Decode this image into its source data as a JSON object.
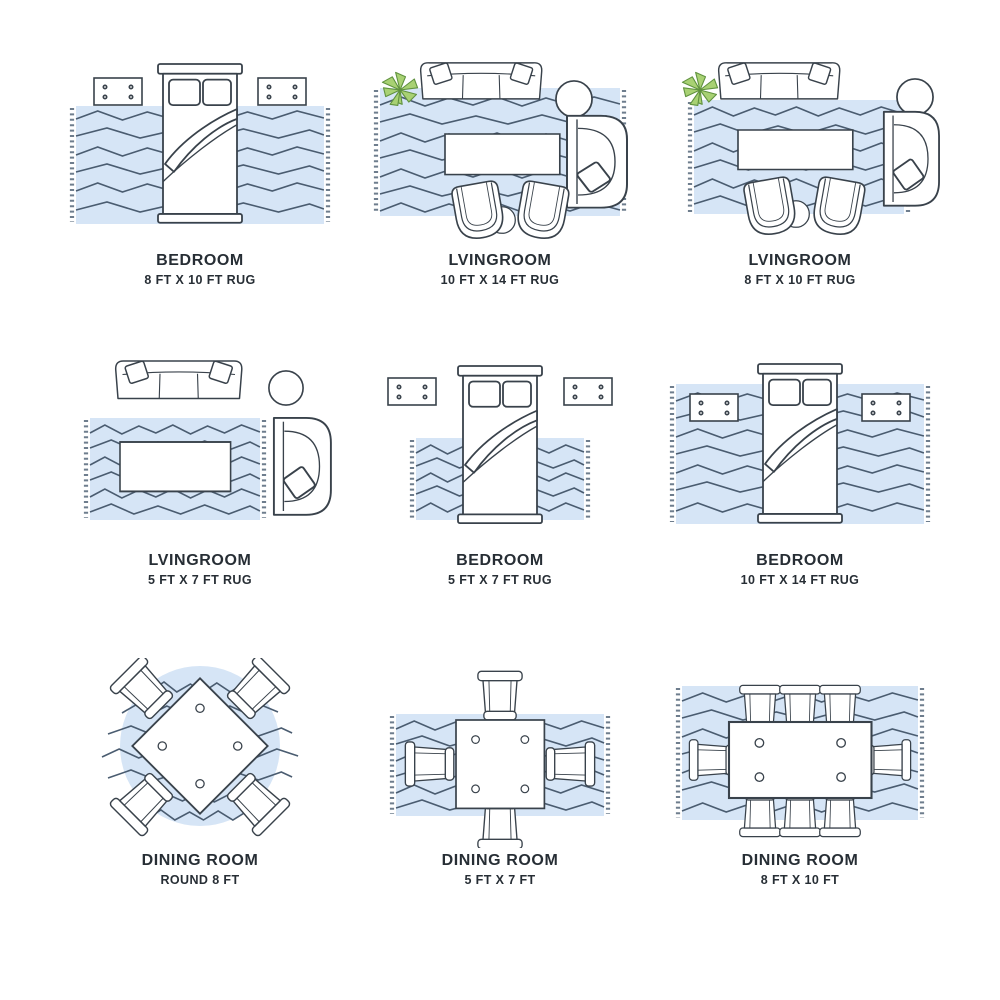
{
  "page": {
    "background": "#ffffff"
  },
  "palette": {
    "rug_fill": "#d6e5f6",
    "pattern_line": "#4a5c70",
    "furniture_line": "#39424b",
    "furniture_fill": "#ffffff",
    "plant_green": "#a8d173",
    "label_text": "#272e35"
  },
  "cells": [
    {
      "room": "BEDROOM",
      "size": "8 FT X 10 FT RUG",
      "rug_shape": "rectangle",
      "furniture": [
        "bed",
        "nightstand",
        "nightstand"
      ]
    },
    {
      "room": "LVINGROOM",
      "size": "10 FT X 14 FT RUG",
      "rug_shape": "rectangle",
      "furniture": [
        "sofa",
        "plant",
        "side-table",
        "armchair",
        "coffee-table",
        "accent-chair",
        "accent-chair",
        "side-table"
      ]
    },
    {
      "room": "LVINGROOM",
      "size": "8 FT X 10 FT RUG",
      "rug_shape": "rectangle",
      "furniture": [
        "sofa",
        "plant",
        "side-table",
        "armchair",
        "coffee-table",
        "accent-chair",
        "accent-chair",
        "side-table"
      ]
    },
    {
      "room": "LVINGROOM",
      "size": "5 FT X 7 FT RUG",
      "rug_shape": "rectangle",
      "furniture": [
        "sofa",
        "side-table",
        "armchair",
        "coffee-table"
      ]
    },
    {
      "room": "BEDROOM",
      "size": "5 FT X 7 FT RUG",
      "rug_shape": "rectangle",
      "furniture": [
        "bed",
        "nightstand",
        "nightstand"
      ]
    },
    {
      "room": "BEDROOM",
      "size": "10 FT X 14 FT RUG",
      "rug_shape": "rectangle",
      "furniture": [
        "bed",
        "nightstand",
        "nightstand"
      ]
    },
    {
      "room": "DINING ROOM",
      "size": "ROUND 8 FT",
      "rug_shape": "circle",
      "furniture": [
        "square-table",
        "chair",
        "chair",
        "chair",
        "chair"
      ]
    },
    {
      "room": "DINING ROOM",
      "size": "5 FT X 7 FT",
      "rug_shape": "rectangle",
      "furniture": [
        "square-table",
        "chair",
        "chair",
        "chair",
        "chair"
      ]
    },
    {
      "room": "DINING ROOM",
      "size": "8 FT X 10 FT",
      "rug_shape": "rectangle",
      "furniture": [
        "rect-table",
        "chair",
        "chair",
        "chair",
        "chair",
        "chair",
        "chair",
        "chair",
        "chair"
      ]
    }
  ]
}
